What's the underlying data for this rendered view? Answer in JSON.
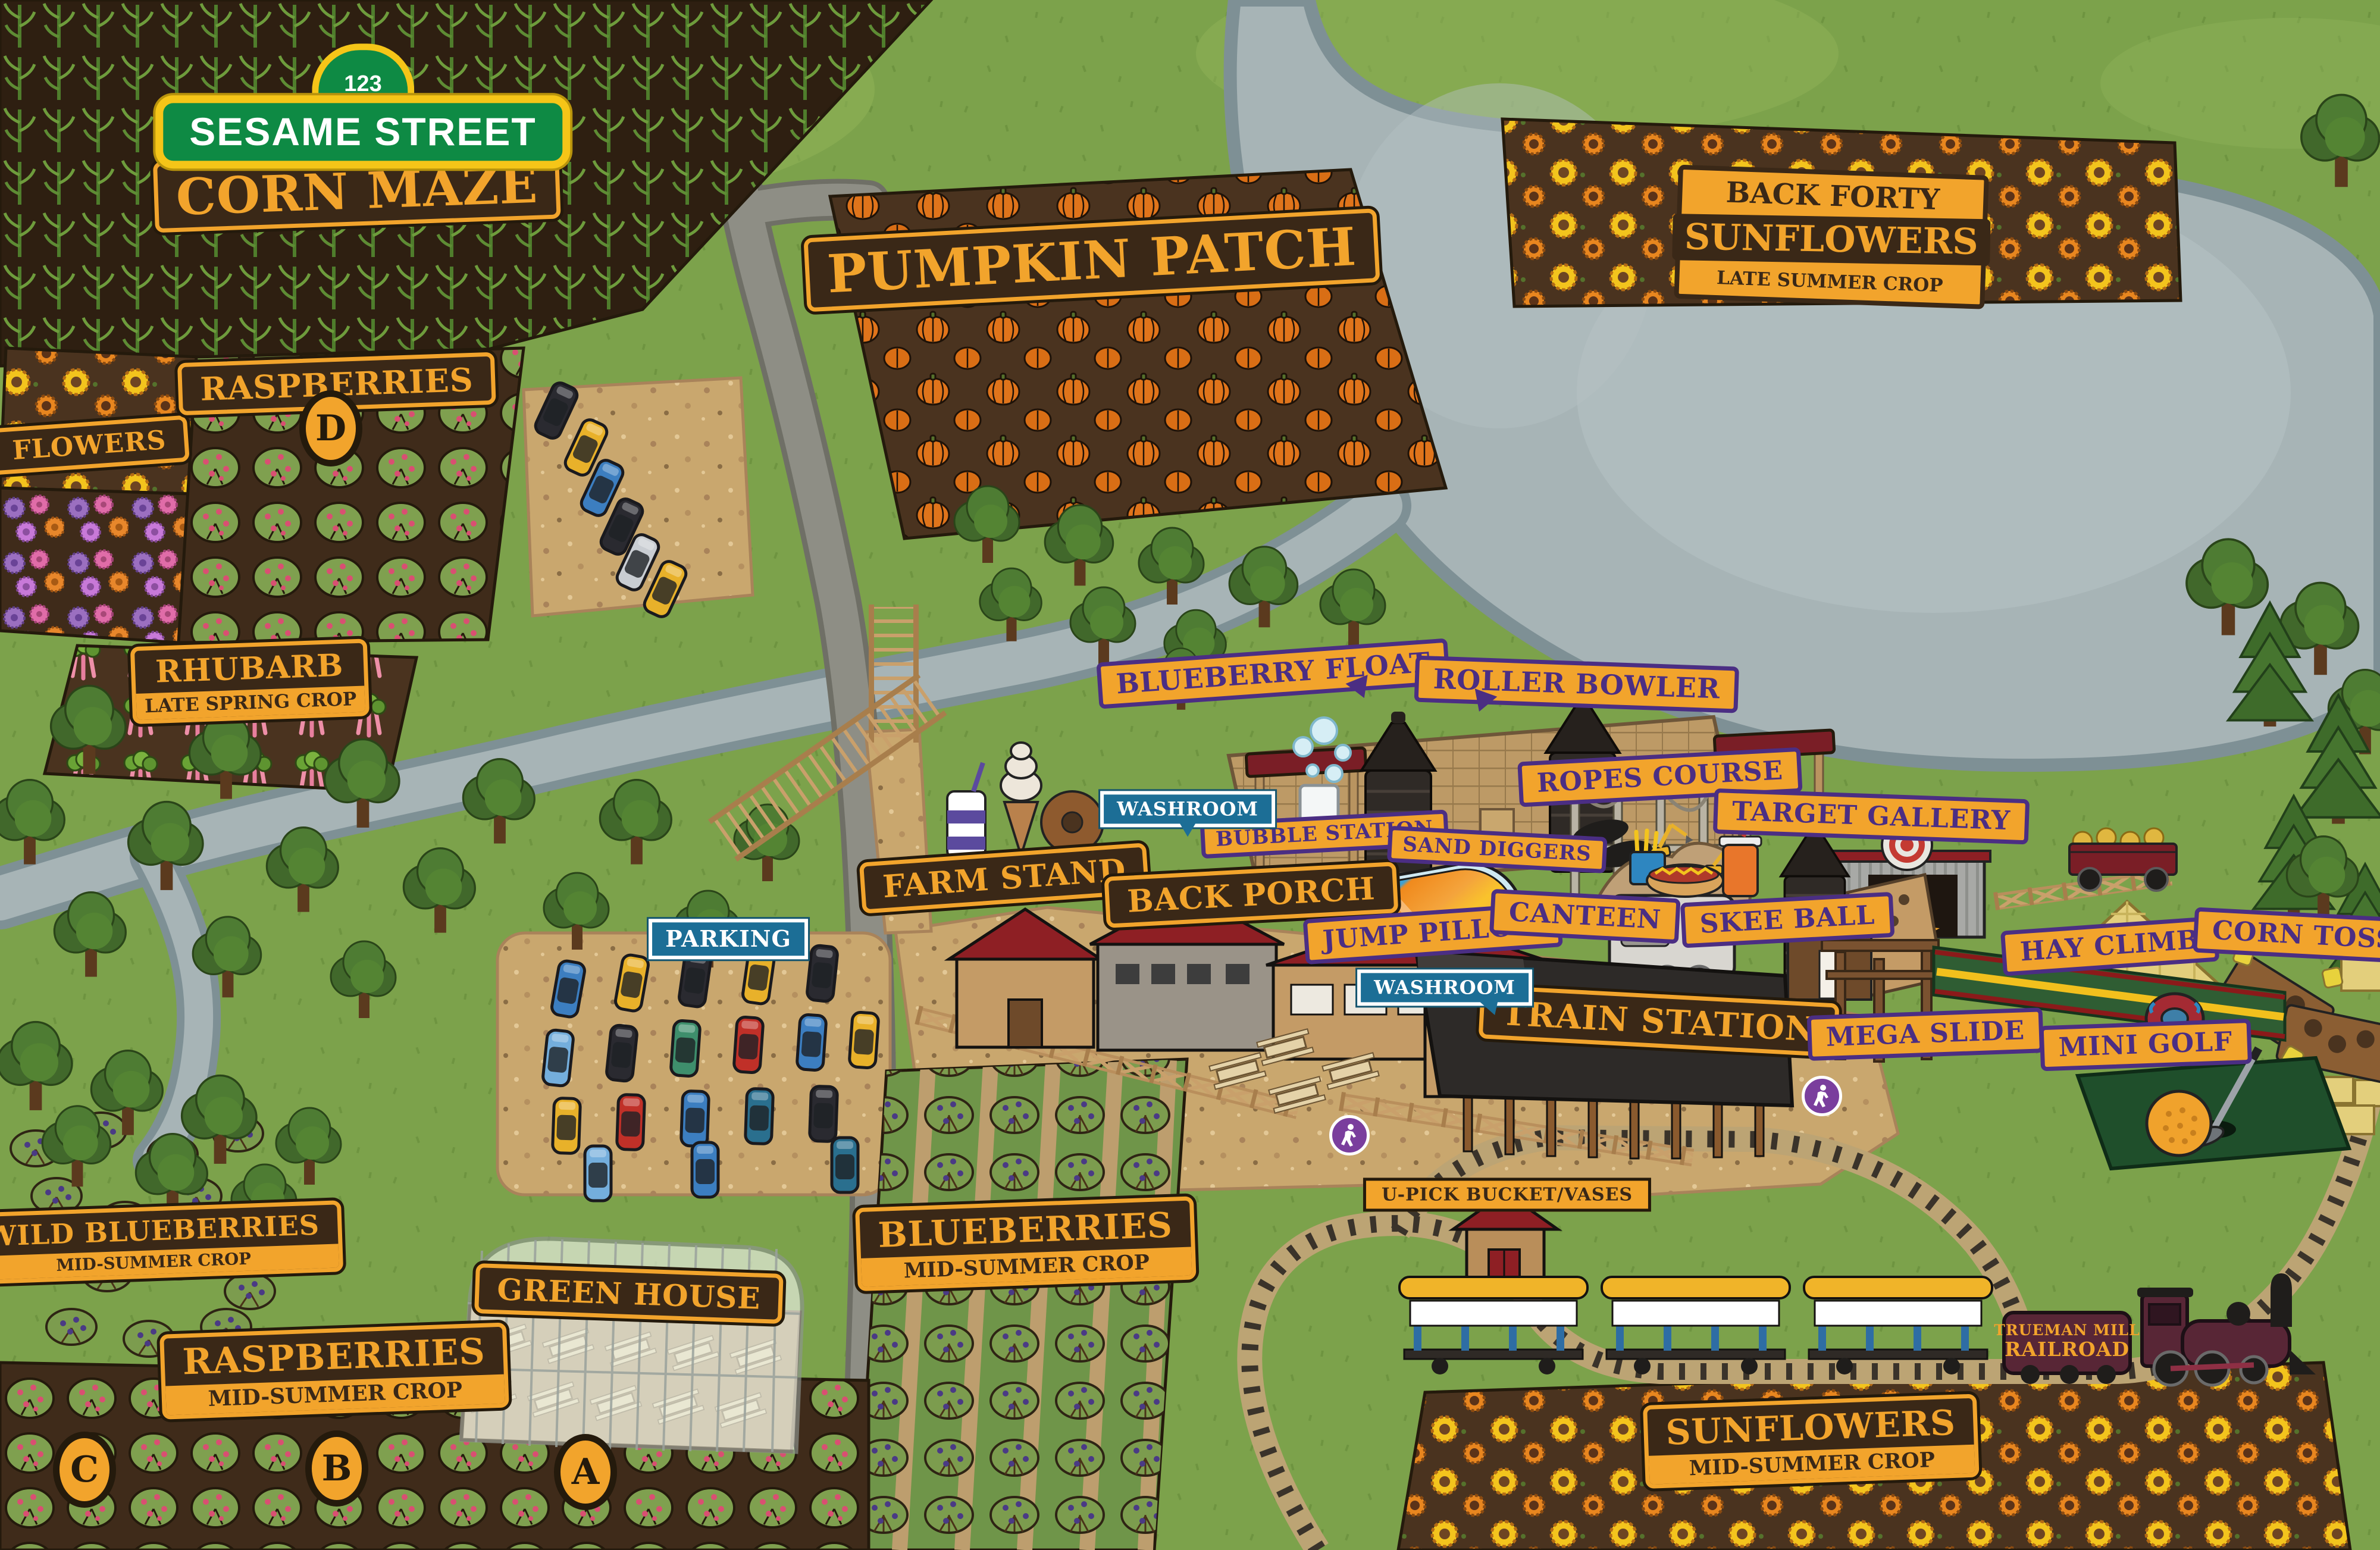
{
  "signs": {
    "sesame": {
      "number": "123",
      "street": "SESAME STREET",
      "maze": "CORN MAZE"
    },
    "crops": {
      "flowers": {
        "title": "FLOWERS"
      },
      "raspberries_d": {
        "title": "RASPBERRIES",
        "badge": "D"
      },
      "rhubarb": {
        "title": "RHUBARB",
        "subtitle": "LATE SPRING CROP"
      },
      "pumpkin_patch": {
        "title": "PUMPKIN PATCH"
      },
      "back_forty": {
        "pre": "BACK FORTY",
        "title": "SUNFLOWERS",
        "subtitle": "LATE SUMMER CROP"
      },
      "wild_blueberries": {
        "title": "WILD BLUEBERRIES",
        "subtitle": "MID-SUMMER CROP"
      },
      "blueberries": {
        "title": "BLUEBERRIES",
        "subtitle": "MID-SUMMER CROP"
      },
      "raspberries_main": {
        "title": "RASPBERRIES",
        "subtitle": "MID-SUMMER CROP",
        "badge_a": "A",
        "badge_b": "B",
        "badge_c": "C"
      },
      "sunflowers_main": {
        "title": "SUNFLOWERS",
        "subtitle": "MID-SUMMER CROP"
      },
      "green_house": {
        "title": "GREEN HOUSE"
      }
    },
    "attractions": {
      "blueberry_float": "BLUEBERRY FLOAT",
      "roller_bowler": "ROLLER BOWLER",
      "ropes_course": "ROPES COURSE",
      "target_gallery": "TARGET GALLERY",
      "bubble_station": "BUBBLE STATION",
      "sand_diggers": "SAND DIGGERS",
      "jump_pillow": "JUMP PILLOW",
      "canteen": "CANTEEN",
      "skee_ball": "SKEE BALL",
      "hay_climb": "HAY CLIMB",
      "corn_toss": "CORN TOSS",
      "mega_slide": "MEGA SLIDE",
      "mini_golf": "MINI GOLF"
    },
    "places": {
      "farm_stand": "FARM STAND",
      "back_porch": "BACK PORCH",
      "train_station": "TRAIN STATION",
      "upick": "U-PICK BUCKET/VASES"
    },
    "info": {
      "parking": "PARKING",
      "washroom_back_porch": "WASHROOM",
      "washroom_station": "WASHROOM"
    },
    "train": {
      "line1": "TRUEMAN MILL",
      "line2": "RAILROAD"
    }
  },
  "colors": {
    "grass": "#7CA24B",
    "water": "#A7B4B6",
    "soil": "#4A331F",
    "dirt": "#C9A76E",
    "sign_orange": "#F2A42C",
    "sign_purple": "#4B2E83",
    "sign_brown": "#3A2817",
    "info_blue": "#1C6E96",
    "sesame_green": "#0E8A44",
    "sesame_yellow": "#F5C518"
  }
}
